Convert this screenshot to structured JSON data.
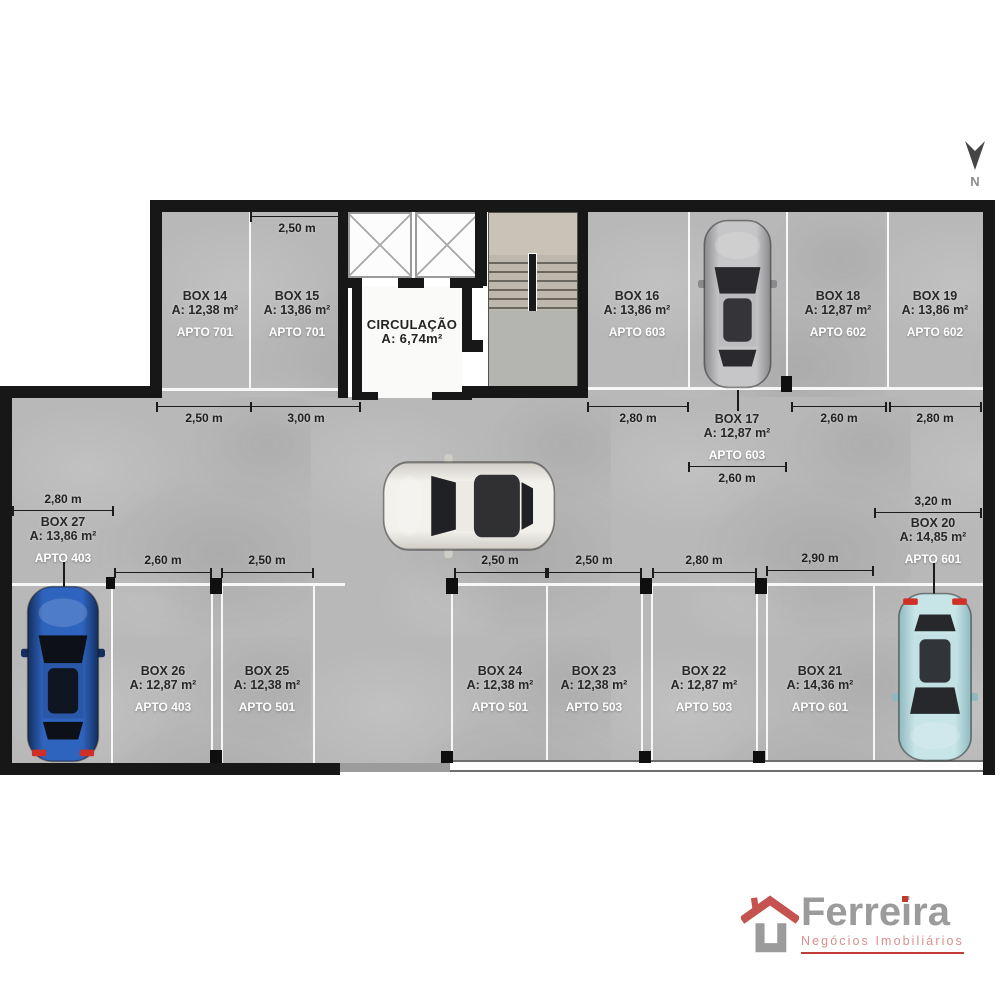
{
  "north": {
    "label": "N"
  },
  "circulation": {
    "title": "CIRCULAÇÃO",
    "area": "A: 6,74m²"
  },
  "boxes": [
    {
      "id": "box-14",
      "title": "BOX 14",
      "area": "A: 12,38 m²",
      "apto": "APTO 701",
      "cx": 205,
      "top": 290
    },
    {
      "id": "box-15",
      "title": "BOX 15",
      "area": "A: 13,86 m²",
      "apto": "APTO 701",
      "cx": 297,
      "top": 290
    },
    {
      "id": "box-16",
      "title": "BOX 16",
      "area": "A: 13,86 m²",
      "apto": "APTO 603",
      "cx": 637,
      "top": 290
    },
    {
      "id": "box-18",
      "title": "BOX 18",
      "area": "A: 12,87 m²",
      "apto": "APTO 602",
      "cx": 838,
      "top": 290
    },
    {
      "id": "box-19",
      "title": "BOX 19",
      "area": "A: 13,86 m²",
      "apto": "APTO 602",
      "cx": 935,
      "top": 290
    },
    {
      "id": "box-17",
      "title": "BOX 17",
      "area": "A: 12,87 m²",
      "apto": "APTO 603",
      "cx": 737,
      "top": 413
    },
    {
      "id": "box-27",
      "title": "BOX 27",
      "area": "A: 13,86 m²",
      "apto": "APTO 403",
      "cx": 63,
      "top": 516
    },
    {
      "id": "box-20",
      "title": "BOX 20",
      "area": "A: 14,85 m²",
      "apto": "APTO 601",
      "cx": 933,
      "top": 517
    },
    {
      "id": "box-26",
      "title": "BOX 26",
      "area": "A: 12,87 m²",
      "apto": "APTO 403",
      "cx": 163,
      "top": 665
    },
    {
      "id": "box-25",
      "title": "BOX 25",
      "area": "A: 12,38 m²",
      "apto": "APTO 501",
      "cx": 267,
      "top": 665
    },
    {
      "id": "box-24",
      "title": "BOX 24",
      "area": "A: 12,38 m²",
      "apto": "APTO 501",
      "cx": 500,
      "top": 665
    },
    {
      "id": "box-23",
      "title": "BOX 23",
      "area": "A: 12,38 m²",
      "apto": "APTO 503",
      "cx": 594,
      "top": 665
    },
    {
      "id": "box-22",
      "title": "BOX 22",
      "area": "A: 12,87 m²",
      "apto": "APTO 503",
      "cx": 704,
      "top": 665
    },
    {
      "id": "box-21",
      "title": "BOX 21",
      "area": "A: 14,36 m²",
      "apto": "APTO 601",
      "cx": 820,
      "top": 665
    }
  ],
  "dimensions": [
    {
      "label": "2,50 m",
      "x1": 251,
      "x2": 344,
      "y": 216,
      "lx": 297,
      "ly": 221
    },
    {
      "label": "2,50 m",
      "x1": 157,
      "x2": 251,
      "y": 406,
      "lx": 204,
      "ly": 411
    },
    {
      "label": "3,00 m",
      "x1": 251,
      "x2": 360,
      "y": 406,
      "lx": 306,
      "ly": 411
    },
    {
      "label": "2,80 m",
      "x1": 588,
      "x2": 688,
      "y": 406,
      "lx": 638,
      "ly": 411
    },
    {
      "label": "2,60 m",
      "x1": 792,
      "x2": 886,
      "y": 406,
      "lx": 839,
      "ly": 411
    },
    {
      "label": "2,80 m",
      "x1": 890,
      "x2": 981,
      "y": 406,
      "lx": 935,
      "ly": 411
    },
    {
      "label": "2,60 m",
      "x1": 689,
      "x2": 786,
      "y": 466,
      "lx": 737,
      "ly": 471
    },
    {
      "label": "2,80 m",
      "x1": 13,
      "x2": 113,
      "y": 510,
      "lx": 63,
      "ly": 492
    },
    {
      "label": "3,20 m",
      "x1": 875,
      "x2": 981,
      "y": 512,
      "lx": 933,
      "ly": 494
    },
    {
      "label": "2,60 m",
      "x1": 115,
      "x2": 211,
      "y": 572,
      "lx": 163,
      "ly": 553
    },
    {
      "label": "2,50 m",
      "x1": 222,
      "x2": 313,
      "y": 572,
      "lx": 267,
      "ly": 553
    },
    {
      "label": "2,50 m",
      "x1": 455,
      "x2": 546,
      "y": 572,
      "lx": 500,
      "ly": 553
    },
    {
      "label": "2,50 m",
      "x1": 548,
      "x2": 641,
      "y": 572,
      "lx": 594,
      "ly": 553
    },
    {
      "label": "2,80 m",
      "x1": 653,
      "x2": 756,
      "y": 572,
      "lx": 704,
      "ly": 553
    },
    {
      "label": "2,90 m",
      "x1": 767,
      "x2": 873,
      "y": 570,
      "lx": 820,
      "ly": 551
    }
  ],
  "leaders": [
    {
      "x": 63,
      "y1": 562,
      "y2": 600
    },
    {
      "x": 933,
      "y1": 563,
      "y2": 598
    },
    {
      "x": 737,
      "y1": 390,
      "y2": 411
    }
  ],
  "cars": [
    {
      "name": "parked-car-box-17",
      "style": "silver sedan",
      "x": 698,
      "y": 219,
      "w": 79,
      "h": 170,
      "orient": "v",
      "flip": false,
      "body": "#c6c6c8",
      "body2": "#8a8a8d",
      "roof": "#bcbcbf",
      "glass": "#2a2a2e",
      "tail": null
    },
    {
      "name": "driving-car-aisle",
      "style": "white hatchback",
      "x": 382,
      "y": 454,
      "w": 174,
      "h": 104,
      "orient": "h",
      "flip": false,
      "body": "#f3f1ec",
      "body2": "#cfccc5",
      "roof": "#eceae3",
      "glass": "#202124",
      "tail": null
    },
    {
      "name": "parked-car-box-27",
      "style": "blue suv",
      "x": 21,
      "y": 585,
      "w": 84,
      "h": 178,
      "orient": "v",
      "flip": false,
      "body": "#2e63be",
      "body2": "#142f5e",
      "roof": "#2a57a8",
      "glass": "#0d1117",
      "tail": "#cf2f26"
    },
    {
      "name": "parked-car-box-20",
      "style": "light blue sedan",
      "x": 892,
      "y": 592,
      "w": 86,
      "h": 170,
      "orient": "v",
      "flip": true,
      "body": "#c7e4e7",
      "body2": "#8fb9be",
      "roof": "#c3e1e4",
      "glass": "#26282c",
      "tail": "#cf2f26"
    }
  ],
  "logo": {
    "title": "Ferreira",
    "subtitle": "Negócios Imobiliários",
    "title_color": "#9b9b9b",
    "subtitle_color": "#d98f8f",
    "roof_color": "#c4524e",
    "underline_color": "#c23b36"
  }
}
